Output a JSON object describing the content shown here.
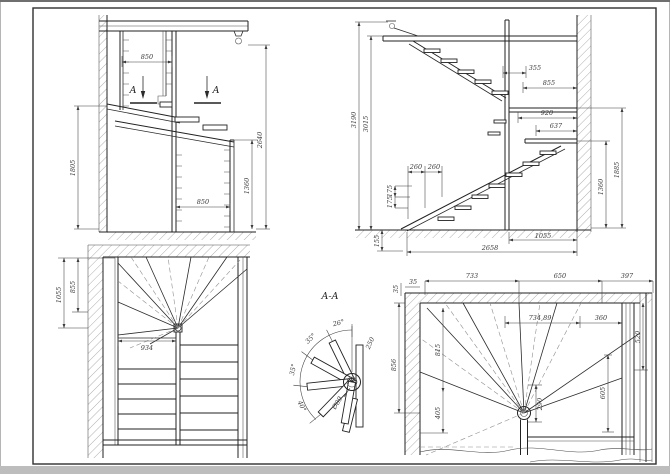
{
  "drawing_title": "A-A",
  "front_section": {
    "section_letter": "A",
    "dims": {
      "top_width": "850",
      "bottom_width": "850",
      "total_height": "2640",
      "left_height": "1805",
      "right_height": "1360"
    }
  },
  "side_section": {
    "dims": {
      "h_total": "3190",
      "h_inner": "3015",
      "offset_top": "355",
      "width_top": "855",
      "landing_1": "920",
      "landing_2": "637",
      "tread_1": "260",
      "tread_2": "260",
      "riser_1": "175",
      "riser_2": "175",
      "base": "155",
      "right_upper": "1885",
      "right_lower": "1360",
      "run_right": "1055",
      "run_total": "2658"
    }
  },
  "plan_upper": {
    "dims": {
      "depth_outer": "1055",
      "depth_inner": "855",
      "width": "934"
    }
  },
  "detail": {
    "title": "A-A",
    "angles": {
      "a1": "26°",
      "a2": "35°",
      "a3": "35°",
      "a4": "40°"
    },
    "radius": "250",
    "diameter": "Ø89"
  },
  "plan_lower": {
    "dims": {
      "wall_thk_v": "35",
      "wall_thk_h": "35",
      "top_1": "733",
      "top_2": "650",
      "top_3": "397",
      "span_1": "734,89",
      "span_2": "360",
      "right_outer": "520",
      "right_inner": "605",
      "left_outer": "856",
      "left_inner": "815",
      "left_lower": "405",
      "tread": "290"
    }
  }
}
